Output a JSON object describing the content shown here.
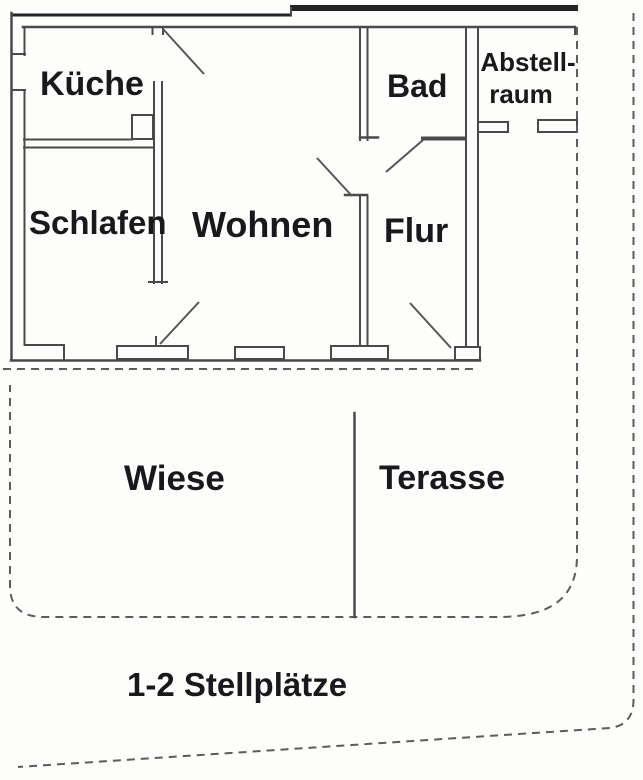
{
  "plan": {
    "rooms": {
      "kueche": "Küche",
      "bad": "Bad",
      "abstellraum_line1": "Abstell-",
      "abstellraum_line2": "raum",
      "schlafen": "Schlafen",
      "wohnen": "Wohnen",
      "flur": "Flur"
    },
    "outdoor": {
      "wiese": "Wiese",
      "terasse": "Terasse",
      "stellplaetze": "1-2 Stellplätze"
    },
    "colors": {
      "wall": "#4a4a4a",
      "wall_heavy": "#242424",
      "label_text": "#18181d",
      "boundary_dash": "#5c5c5c",
      "background": "#fdfdfc"
    }
  }
}
